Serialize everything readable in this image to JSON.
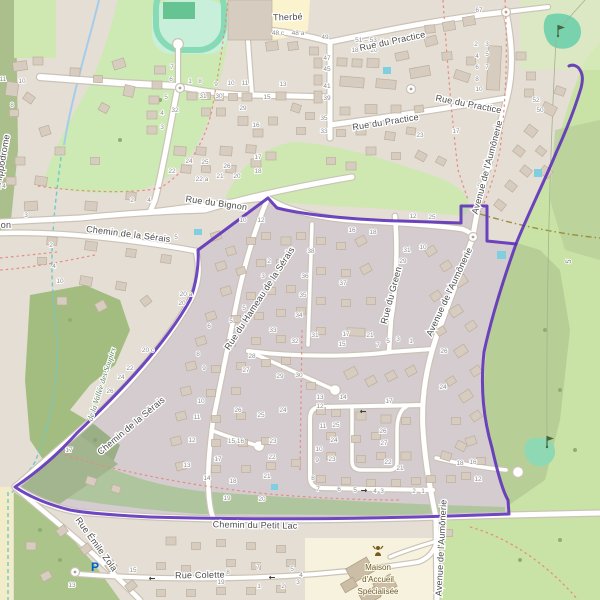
{
  "map": {
    "colors": {
      "selection_stroke": "#5b2db8",
      "selection_fill": "rgba(110,85,180,0.13)",
      "residential": "#e4ded4",
      "building": "#d6ccc0",
      "park_green": "#cdeab4",
      "golf_green": "#c9e2a6",
      "golf_putting_green": "#79d2ae",
      "water": "#a5cdea",
      "footpath_red": "#e98a7e",
      "parking_blue": "#0061ce"
    },
    "street_labels": [
      {
        "text": "Therbé",
        "x": 288,
        "y": 20,
        "rot": -2
      },
      {
        "text": "Rue du Practice",
        "x": 393,
        "y": 44,
        "rot": -12
      },
      {
        "text": "Rue du Practice",
        "x": 468,
        "y": 107,
        "rot": 11
      },
      {
        "text": "Rue du Practice",
        "x": 386,
        "y": 125,
        "rot": -9
      },
      {
        "text": "Rue du Bignon",
        "x": 216,
        "y": 206,
        "rot": 8
      },
      {
        "text": "Chemin de la Sérais",
        "x": 128,
        "y": 237,
        "rot": 7
      },
      {
        "text": "Chemin de la Sérais",
        "x": 133,
        "y": 428,
        "rot": -40
      },
      {
        "text": "Rue du Hameau de la Sérais",
        "x": 262,
        "y": 300,
        "rot": -57
      },
      {
        "text": "Rue du Green",
        "x": 394,
        "y": 296,
        "rot": -75
      },
      {
        "text": "Avenue de l'Aumônerie",
        "x": 452,
        "y": 293,
        "rot": -65
      },
      {
        "text": "Avenue de l'Aumônerie",
        "x": 490,
        "y": 168,
        "rot": -75
      },
      {
        "text": "Avenue de l'Aumônerie",
        "x": 444,
        "y": 548,
        "rot": -87
      },
      {
        "text": "Chemin du Petit Lac",
        "x": 255,
        "y": 528,
        "rot": 1
      },
      {
        "text": "Rue Émile Zola",
        "x": 94,
        "y": 546,
        "rot": 54
      },
      {
        "text": "Rue Colette",
        "x": 200,
        "y": 578,
        "rot": -1
      },
      {
        "text": "on",
        "x": 6,
        "y": 228,
        "rot": 0
      },
      {
        "text": "l'Hippodrome",
        "x": 5,
        "y": 162,
        "rot": -80
      }
    ],
    "poi_labels": [
      {
        "kind": "park",
        "text": "de la Vallée des Soupirs",
        "x": 104,
        "y": 385,
        "rot": -72
      },
      {
        "kind": "golf",
        "text": "5",
        "x": 571,
        "y": 262,
        "rot": -80
      }
    ],
    "mas": {
      "lines": [
        "Maison",
        "d'Accueil",
        "Spécialisée"
      ],
      "x": 378,
      "y": 570,
      "line_h": 12
    },
    "house_numbers": [
      [
        "11",
        3,
        81
      ],
      [
        "10",
        22,
        83
      ],
      [
        "8",
        12,
        107
      ],
      [
        "6",
        5,
        147
      ],
      [
        "5",
        2,
        167
      ],
      [
        "4",
        4,
        188
      ],
      [
        "3",
        26,
        217
      ],
      [
        "2",
        51,
        247
      ],
      [
        "4",
        54,
        268
      ],
      [
        "10",
        60,
        283
      ],
      [
        "7",
        172,
        69
      ],
      [
        "6",
        171,
        81
      ],
      [
        "5",
        166,
        99
      ],
      [
        "4",
        162,
        115
      ],
      [
        "3",
        162,
        129
      ],
      [
        "1",
        190,
        83
      ],
      [
        "8",
        200,
        83
      ],
      [
        "9",
        216,
        86
      ],
      [
        "10",
        231,
        85
      ],
      [
        "11",
        245,
        85
      ],
      [
        "13",
        283,
        86
      ],
      [
        "15",
        267,
        99
      ],
      [
        "31",
        203,
        98
      ],
      [
        "30",
        219,
        98
      ],
      [
        "29",
        243,
        110
      ],
      [
        "16",
        256,
        127
      ],
      [
        "32",
        175,
        112
      ],
      [
        "48 c",
        278,
        35
      ],
      [
        "48 a",
        298,
        35
      ],
      [
        "49",
        325,
        39
      ],
      [
        "51 – 53",
        366,
        42
      ],
      [
        "18",
        355,
        52
      ],
      [
        "20",
        374,
        52
      ],
      [
        "47",
        327,
        60
      ],
      [
        "45",
        327,
        71
      ],
      [
        "41",
        327,
        88
      ],
      [
        "39",
        327,
        100
      ],
      [
        "35",
        324,
        120
      ],
      [
        "33",
        324,
        133
      ],
      [
        "67",
        479,
        12
      ],
      [
        "2",
        476,
        46
      ],
      [
        "3",
        487,
        46
      ],
      [
        "4",
        477,
        58
      ],
      [
        "5",
        487,
        56
      ],
      [
        "6",
        477,
        69
      ],
      [
        "7",
        487,
        69
      ],
      [
        "8",
        477,
        81
      ],
      [
        "10",
        479,
        91
      ],
      [
        "52",
        536,
        102
      ],
      [
        "50",
        540,
        112
      ],
      [
        "23",
        420,
        137
      ],
      [
        "17",
        456,
        133
      ],
      [
        "24",
        189,
        163
      ],
      [
        "25",
        205,
        164
      ],
      [
        "26",
        227,
        168
      ],
      [
        "22",
        172,
        173
      ],
      [
        "22 a",
        202,
        181
      ],
      [
        "21",
        220,
        178
      ],
      [
        "20",
        237,
        178
      ],
      [
        "17",
        258,
        159
      ],
      [
        "18",
        258,
        173
      ],
      [
        "2",
        132,
        202
      ],
      [
        "4",
        149,
        202
      ],
      [
        "5",
        176,
        239
      ],
      [
        "10",
        243,
        222
      ],
      [
        "12",
        261,
        222
      ],
      [
        "20 a",
        186,
        296
      ],
      [
        "20",
        182,
        305
      ],
      [
        "20 c",
        148,
        352
      ],
      [
        "22",
        130,
        370
      ],
      [
        "24",
        121,
        379
      ],
      [
        "26",
        110,
        393
      ],
      [
        "2",
        269,
        263
      ],
      [
        "3",
        263,
        278
      ],
      [
        "5",
        244,
        310
      ],
      [
        "5",
        231,
        323
      ],
      [
        "6",
        209,
        328
      ],
      [
        "8",
        198,
        356
      ],
      [
        "9",
        204,
        370
      ],
      [
        "10",
        201,
        403
      ],
      [
        "11",
        197,
        419
      ],
      [
        "12",
        192,
        442
      ],
      [
        "13",
        187,
        467
      ],
      [
        "14",
        207,
        480
      ],
      [
        "38",
        311,
        253
      ],
      [
        "36",
        305,
        278
      ],
      [
        "35",
        303,
        297
      ],
      [
        "34",
        299,
        317
      ],
      [
        "33",
        273,
        332
      ],
      [
        "32",
        295,
        343
      ],
      [
        "31",
        315,
        337
      ],
      [
        "37",
        343,
        285
      ],
      [
        "28",
        252,
        358
      ],
      [
        "27",
        246,
        372
      ],
      [
        "29",
        280,
        378
      ],
      [
        "30",
        299,
        377
      ],
      [
        "26",
        238,
        412
      ],
      [
        "25",
        261,
        417
      ],
      [
        "24",
        283,
        412
      ],
      [
        "15 16",
        236,
        443
      ],
      [
        "17",
        218,
        461
      ],
      [
        "18",
        233,
        483
      ],
      [
        "19",
        227,
        500
      ],
      [
        "20",
        262,
        501
      ],
      [
        "21",
        267,
        478
      ],
      [
        "22",
        272,
        459
      ],
      [
        "23",
        273,
        443
      ],
      [
        "16",
        352,
        232
      ],
      [
        "18",
        373,
        234
      ],
      [
        "31",
        407,
        252
      ],
      [
        "29",
        403,
        263
      ],
      [
        "10",
        423,
        249
      ],
      [
        "17",
        346,
        336
      ],
      [
        "21",
        370,
        337
      ],
      [
        "15",
        342,
        346
      ],
      [
        "7",
        378,
        347
      ],
      [
        "5",
        388,
        343
      ],
      [
        "3",
        398,
        341
      ],
      [
        "1",
        411,
        343
      ],
      [
        "26",
        444,
        353
      ],
      [
        "24",
        443,
        389
      ],
      [
        "1",
        490,
        168
      ],
      [
        "5",
        479,
        188
      ],
      [
        "12",
        413,
        218
      ],
      [
        "25",
        432,
        219
      ],
      [
        "13",
        320,
        399
      ],
      [
        "12",
        320,
        408
      ],
      [
        "11",
        323,
        428
      ],
      [
        "10",
        319,
        451
      ],
      [
        "9",
        317,
        462
      ],
      [
        "8",
        313,
        480
      ],
      [
        "7",
        318,
        491
      ],
      [
        "14",
        343,
        399
      ],
      [
        "25",
        336,
        427
      ],
      [
        "24",
        334,
        442
      ],
      [
        "23",
        332,
        461
      ],
      [
        "26",
        383,
        433
      ],
      [
        "27",
        384,
        445
      ],
      [
        "22",
        388,
        464
      ],
      [
        "17",
        389,
        403
      ],
      [
        "6",
        339,
        491
      ],
      [
        "5",
        355,
        492
      ],
      [
        "4",
        375,
        493
      ],
      [
        "3",
        382,
        493
      ],
      [
        "2",
        414,
        493
      ],
      [
        "1",
        423,
        493
      ],
      [
        "21",
        400,
        470
      ],
      [
        "18",
        460,
        465
      ],
      [
        "16",
        473,
        464
      ],
      [
        "12",
        478,
        481
      ],
      [
        "17",
        69,
        452
      ],
      [
        "13",
        72,
        587
      ],
      [
        "15",
        133,
        572
      ],
      [
        "9",
        216,
        576
      ],
      [
        "8",
        228,
        574
      ],
      [
        "19",
        221,
        584
      ],
      [
        "7",
        258,
        569
      ],
      [
        "5",
        292,
        571
      ],
      [
        "4",
        301,
        577
      ],
      [
        "3",
        298,
        584
      ],
      [
        "1",
        259,
        588
      ],
      [
        "2",
        283,
        588
      ]
    ],
    "icons": [
      {
        "type": "parking",
        "x": 95,
        "y": 567
      },
      {
        "type": "golf-pin",
        "x": 558,
        "y": 33
      },
      {
        "type": "golf-pin",
        "x": 547,
        "y": 444
      },
      {
        "type": "social-facility",
        "x": 378,
        "y": 552
      },
      {
        "type": "oneway-left",
        "x": 152,
        "y": 578
      },
      {
        "type": "oneway-left",
        "x": 272,
        "y": 577
      },
      {
        "type": "oneway-left",
        "x": 363,
        "y": 411
      },
      {
        "type": "oneway-right",
        "x": 364,
        "y": 490
      }
    ]
  }
}
